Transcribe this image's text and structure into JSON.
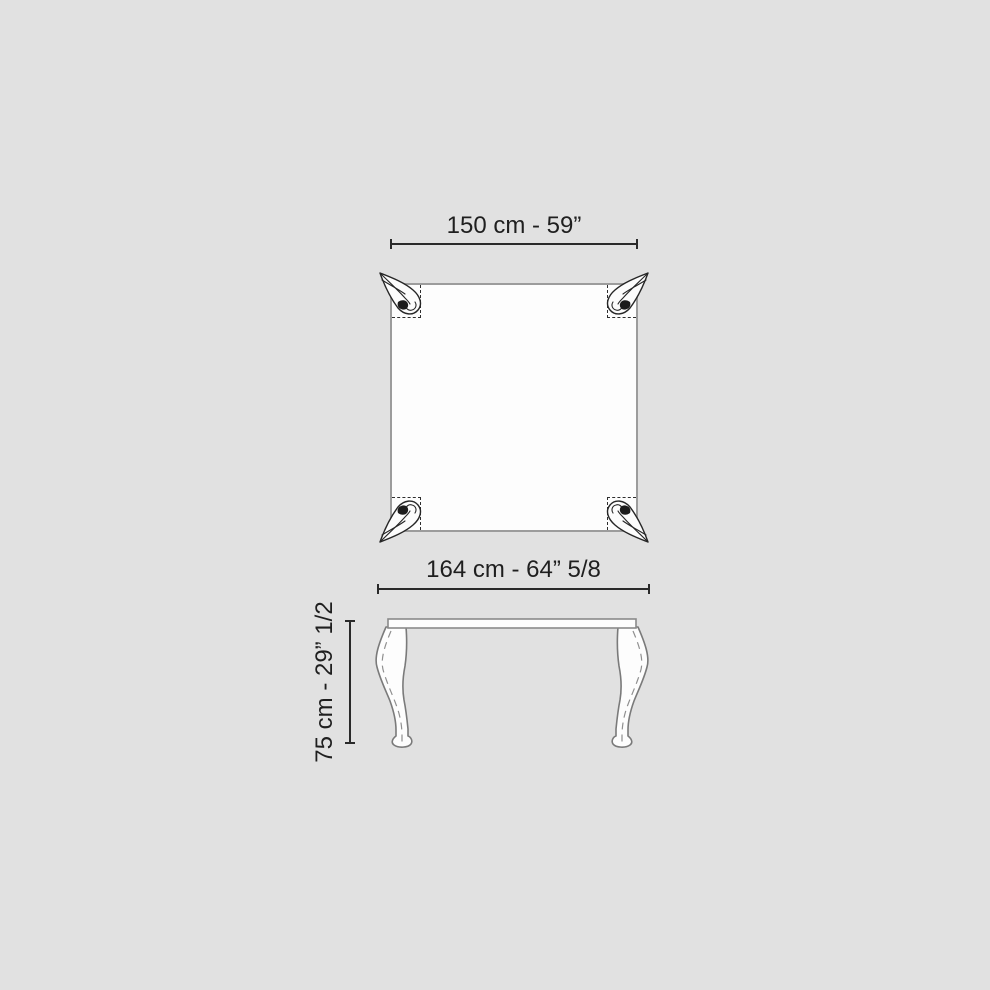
{
  "colors": {
    "background": "#e1e1e1",
    "surface_white": "#fdfdfd",
    "tabletop_border": "#9c9c9c",
    "dimension_line": "#2a2a2a",
    "dashed_outline": "#2e2e2e",
    "front_view_outline": "#7a7a7a",
    "ornament_line": "#262626"
  },
  "icons": {
    "top_view_corner_legs": "carved-leaf-leg-top-view-icon",
    "front_view_legs": "cabriole-leg-icon"
  },
  "diagram": {
    "dimensions": {
      "top_width": "150 cm - 59”",
      "overall_width": "164 cm - 64” 5/8",
      "height": "75 cm - 29” 1/2"
    }
  }
}
